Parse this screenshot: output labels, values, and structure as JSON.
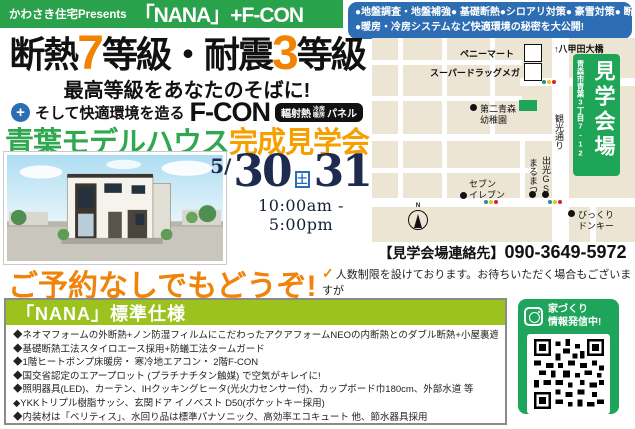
{
  "topbar": {
    "presents": "かわさき住宅Presents",
    "brand": "「NANA」+F-CON",
    "features_line1": "●地盤調査・地盤補強● 基礎断熱●シロアリ対策● 豪雪対策● 断熱材",
    "features_line2": "●暖房・冷房システムなど快適環境の秘密を大公開!"
  },
  "headline": {
    "p1": "断熱",
    "n1": "7",
    "p2": "等級・耐震",
    "n2": "3",
    "p3": "等級",
    "sub": "最高等級をあなたのそばに!",
    "plus": "+",
    "lead": "そして快適環境を造る",
    "fcon": "F-CON",
    "badge_a": "輻射熱",
    "badge_small_top": "冷房",
    "badge_small_bottom": "暖房",
    "badge_b": "パネル",
    "event_green": "青葉モデルハウス",
    "event_orange": "完成見学会"
  },
  "event": {
    "month": "5/",
    "day1": "30",
    "day1_wd": "土",
    "day2": "31",
    "day2_wd": "日",
    "time": "10:00am - 5:00pm"
  },
  "map": {
    "bridge": "↑八甲田大橋",
    "penny_mart": "ペニーマート",
    "drug_mega": "スーパードラッグメガ",
    "kindergarten_1": "第二青森",
    "kindergarten_2": "幼稚園",
    "seven_1": "セブン",
    "seven_2": "イレブン",
    "marumatsu": "まるまつ",
    "idemitsu": "出光GS",
    "donkey_1": "びっくり",
    "donkey_2": "ドンキー",
    "street": "観光通り",
    "venue": "見学会場",
    "address": "青森市青葉3丁目7-12",
    "compass_n": "N",
    "contact_label": "【見学会場連絡先】",
    "contact_phone": "090-3649-5972"
  },
  "reservation": {
    "headline": "ご予約なしでもどうぞ!",
    "check": "✓",
    "note_line1": "人数制限を設けております。お待ちいただく場合もございますが",
    "note_line2": "何卒ご理解ください。"
  },
  "specs": {
    "title": "「NANA」標準仕様",
    "items": [
      "◆ネオマフォームの外断熱+ノン防湿フィルムにこだわったアクアフォームNEOの内断熱とのダブル断熱+小屋裏遮熱材",
      "◆基礎断熱工法スタイロエース採用+防蟻工法タームガード",
      "◆1階ヒートポンプ床暖房・ 寒冷地エアコン・ 2階F-CON",
      "◆国交省認定のエアープロット (プラチナチタン触媒) で空気がキレイに!",
      "◆照明器具(LED)、カーテン、IHクッキングヒータ(光火力センサー付)、カップボード巾180cm、外部水道 等",
      "◆YKKトリプル樹脂サッシ、玄関ドア イノベスト D50(ポケットキー採用)",
      "◆内装材は「ベリティス」、水回り品は標準パナソニック、高効率エコキュート 他、節水器具採用"
    ]
  },
  "social": {
    "label_line1": "家づくり",
    "label_line2": "情報発信中!"
  },
  "colors": {
    "brand_green": "#2aa24b",
    "info_blue": "#2d6db4",
    "accent_orange": "#f08300",
    "event_orange": "#f5a000",
    "specs_green": "#9cc21d",
    "venue_green": "#1fa558",
    "insta_green": "#1ea45b",
    "map_beige": "#ede5d3",
    "date_navy": "#1e2b4e",
    "sat_blue": "#2a6cb5",
    "sun_red": "#d7242c"
  }
}
